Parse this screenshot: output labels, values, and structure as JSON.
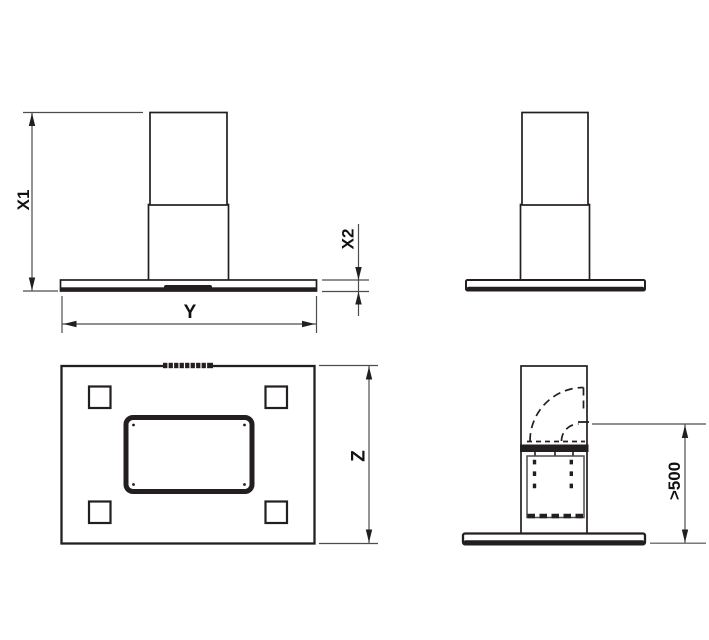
{
  "drawing": {
    "background_color": "#ffffff",
    "line_color": "#231f20",
    "dimension_line_color": "#4d4d4d",
    "label_color": "#111111",
    "labels": {
      "total_height": "X1",
      "body_height": "X2",
      "width": "Y",
      "depth": "Z",
      "min_clearance": ">500"
    }
  }
}
